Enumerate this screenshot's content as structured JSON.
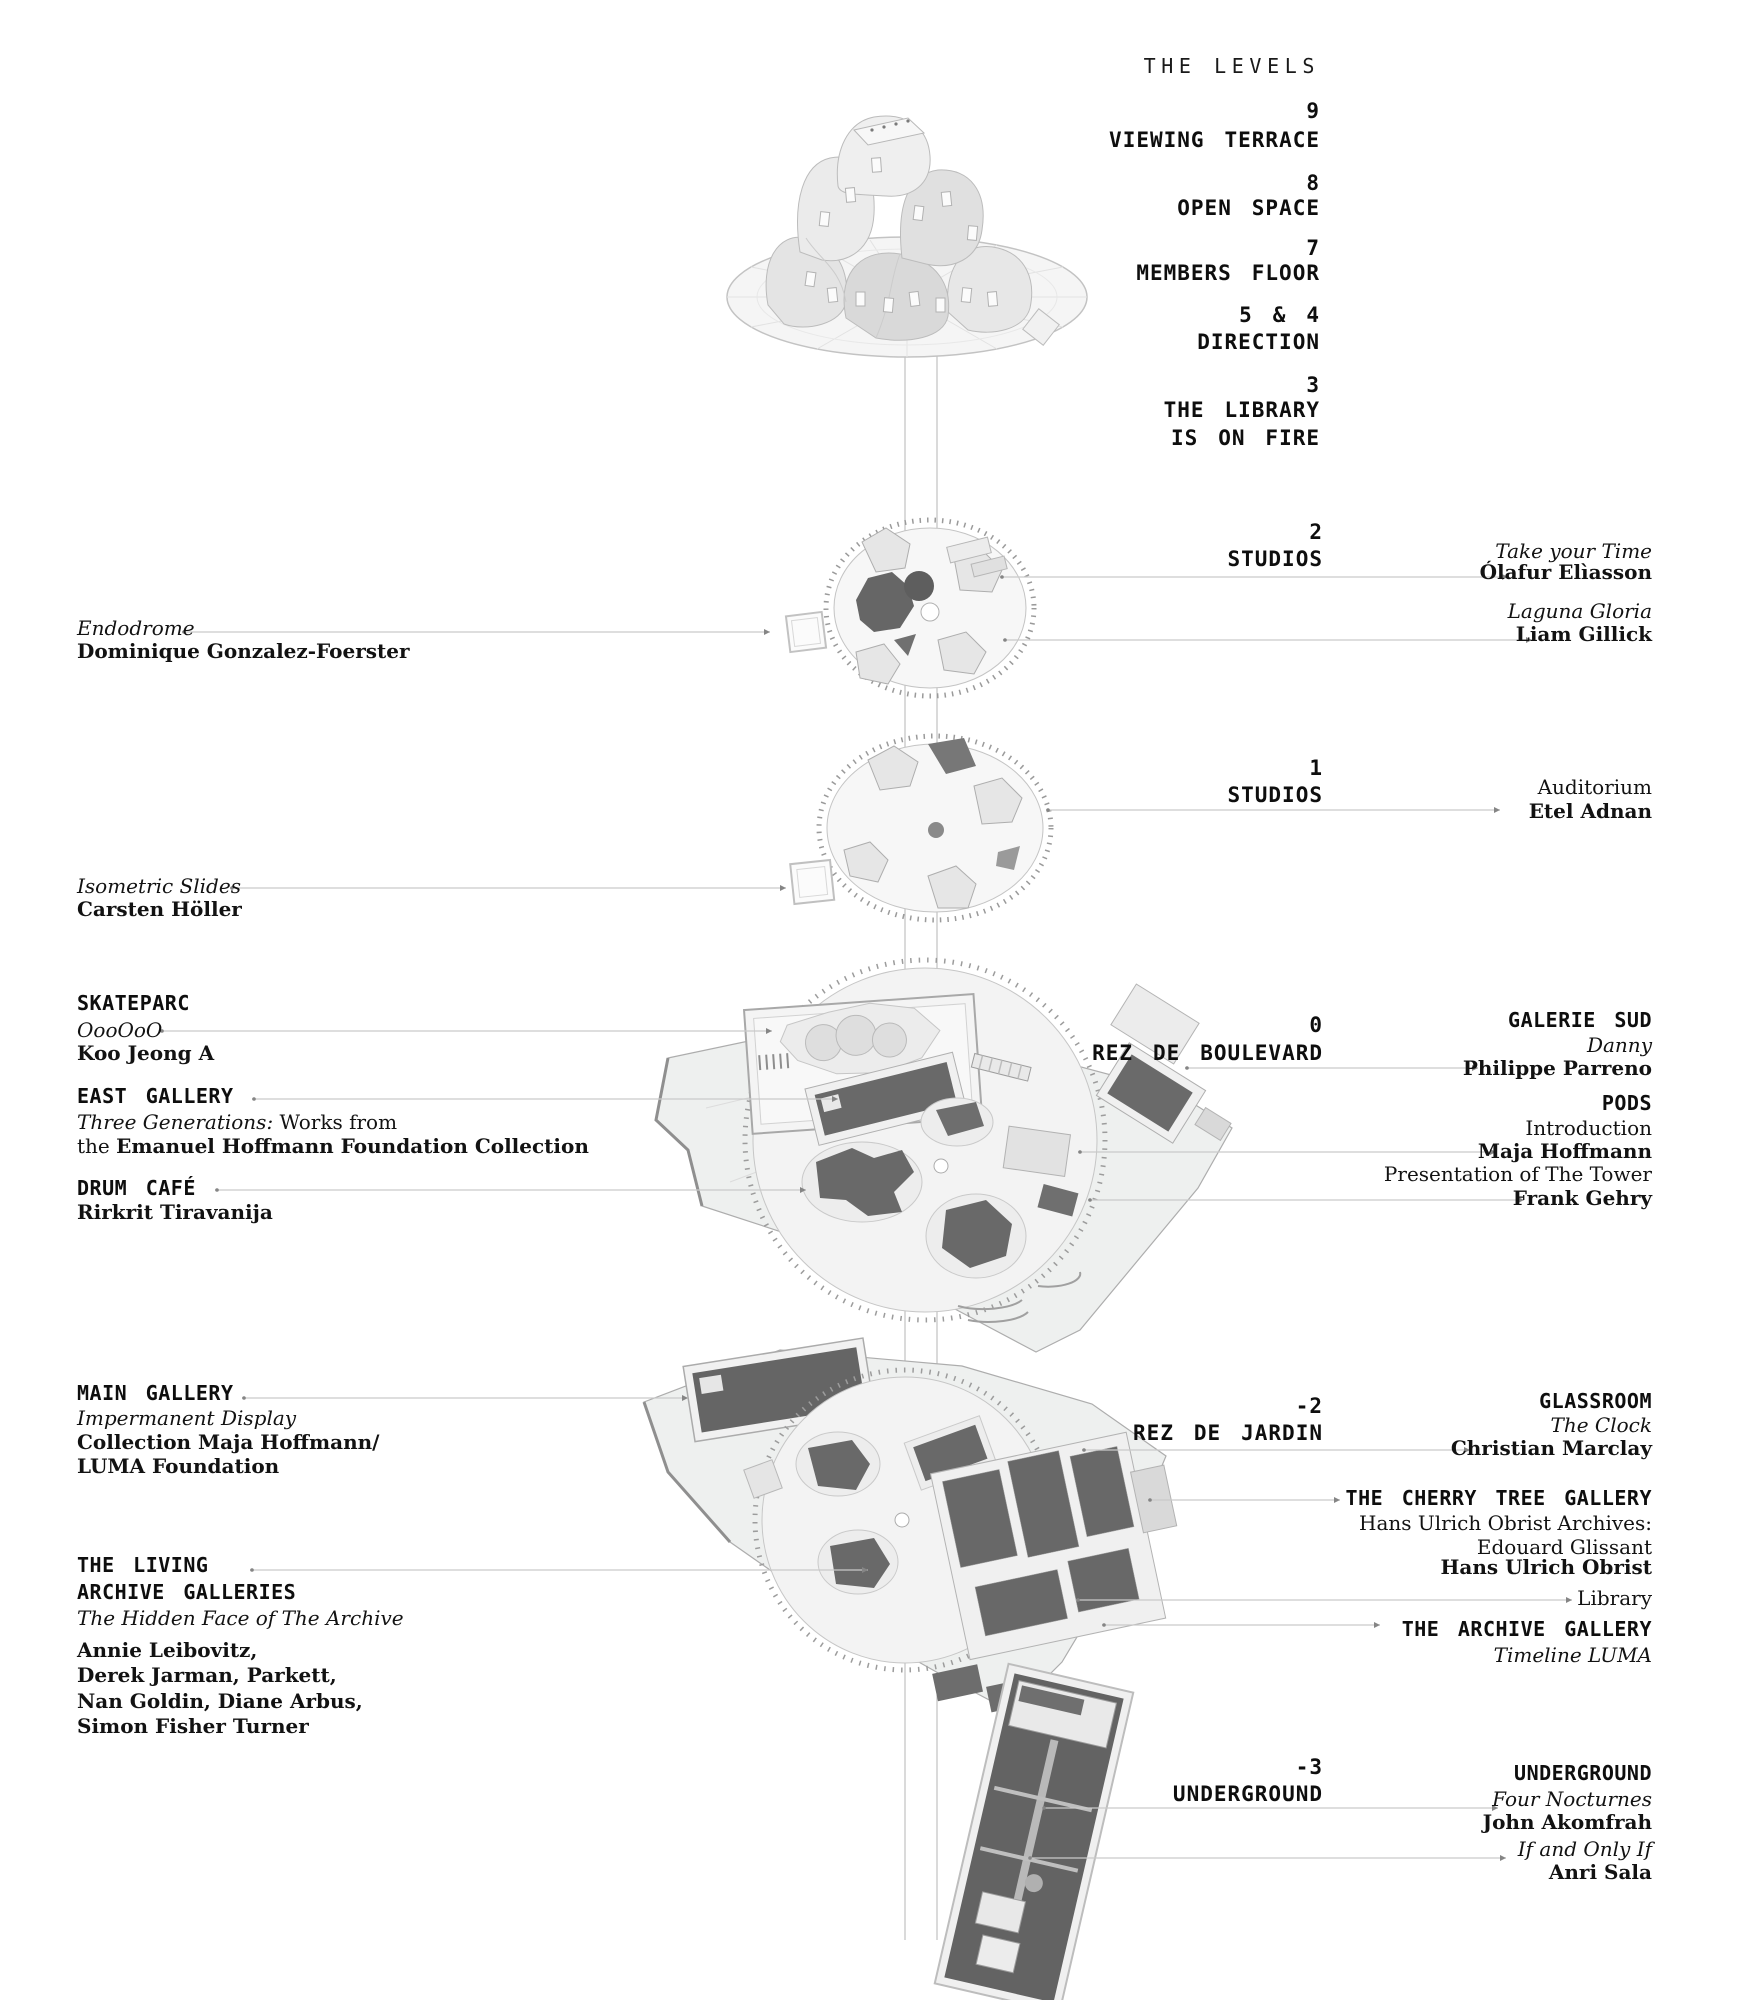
{
  "title": "THE LEVELS",
  "upper_levels": {
    "l9_num": "9",
    "l9_name": "VIEWING TERRACE",
    "l8_num": "8",
    "l8_name": "OPEN SPACE",
    "l7_num": "7",
    "l7_name": "MEMBERS FLOOR",
    "l54_num": "5 & 4",
    "l54_name": "DIRECTION",
    "l3_num": "3",
    "l3_name_line1": "THE LIBRARY",
    "l3_name_line2": "IS ON FIRE"
  },
  "level2": {
    "num": "2",
    "name": "STUDIOS",
    "right": {
      "work1": "Take your Time",
      "artist1": "Ólafur Elìasson",
      "work2": "Laguna Gloria",
      "artist2": "Liam Gillick"
    },
    "left": {
      "work": "Endodrome",
      "artist": "Dominique Gonzalez-Foerster"
    }
  },
  "level1": {
    "num": "1",
    "name": "STUDIOS",
    "right": {
      "venue": "Auditorium",
      "artist": "Etel Adnan"
    },
    "left": {
      "work": "Isometric Slides",
      "artist": "Carsten Höller"
    }
  },
  "level0": {
    "num": "0",
    "name": "REZ DE BOULEVARD",
    "left": {
      "skateparc_heading": "SKATEPARC",
      "skateparc_work": "OooOoO",
      "skateparc_artist": "Koo Jeong A",
      "east_heading": "EAST GALLERY",
      "east_work_italic": "Three Generations:",
      "east_work_rest": " Works from",
      "east_line2_regular": "the ",
      "east_line2_bold": "Emanuel Hoffmann Foundation Collection",
      "drum_heading": "DRUM CAFÉ",
      "drum_artist": "Rirkrit Tiravanija"
    },
    "right": {
      "galerie_heading": "GALERIE SUD",
      "galerie_work": "Danny",
      "galerie_artist": "Philippe Parreno",
      "pods_heading": "PODS",
      "pods_line1": "Introduction",
      "pods_line2": "Maja Hoffmann",
      "pods_line3": "Presentation of The Tower",
      "pods_line4": "Frank Gehry"
    }
  },
  "levelm2": {
    "num": "-2",
    "name": "REZ DE JARDIN",
    "left": {
      "main_heading": "MAIN GALLERY",
      "main_work": "Impermanent Display",
      "main_line1": "Collection Maja Hoffmann/",
      "main_line2": "LUMA Foundation",
      "living_heading1": "THE LIVING",
      "living_heading2": "ARCHIVE GALLERIES",
      "living_work": "The Hidden Face of The Archive",
      "living_artists1": "Annie Leibovitz,",
      "living_artists2": "Derek Jarman, Parkett,",
      "living_artists3": "Nan Goldin, Diane Arbus,",
      "living_artists4": "Simon Fisher Turner"
    },
    "right": {
      "glassroom_heading": "GLASSROOM",
      "glassroom_work": "The Clock",
      "glassroom_artist": "Christian Marclay",
      "cherry_heading": "THE CHERRY TREE GALLERY",
      "cherry_line1": "Hans Ulrich Obrist Archives:",
      "cherry_line2": "Edouard Glissant",
      "cherry_line3": "Hans Ulrich Obrist",
      "library_label": "Library",
      "archive_heading": "THE ARCHIVE GALLERY",
      "archive_work": "Timeline LUMA"
    }
  },
  "levelm3": {
    "num": "-3",
    "name": "UNDERGROUND",
    "right": {
      "heading": "UNDERGROUND",
      "work1": "Four Nocturnes",
      "artist1": "John Akomfrah",
      "work2": "If and Only If",
      "artist2": "Anri Sala"
    }
  },
  "palette": {
    "text": "#111111",
    "leader_line": "#c9c9c9",
    "leader_tick": "#858585",
    "dark_shape": "#696969",
    "light_shape": "#efefef",
    "outline": "#b5b5b5"
  }
}
